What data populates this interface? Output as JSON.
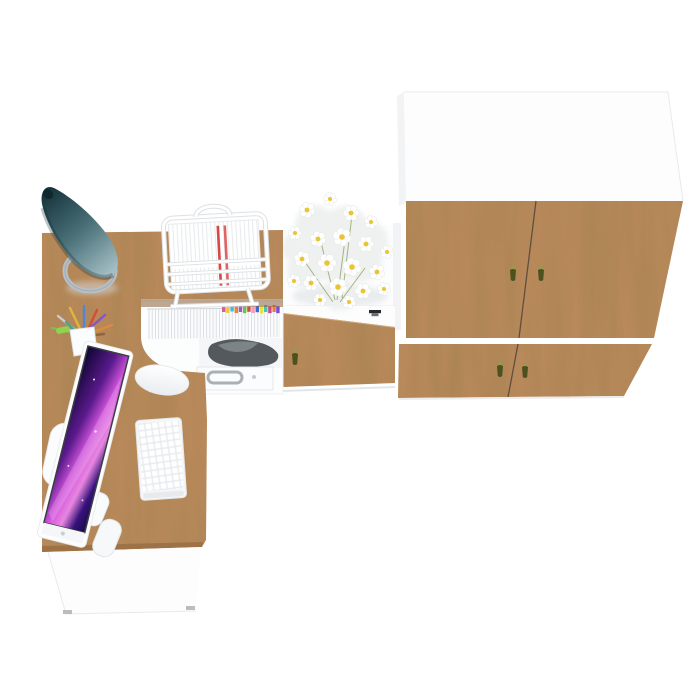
{
  "meta": {
    "description": "Top-down 3D product render of a home-office furniture set: L-shaped oak desk with white base, hutch shelf with files, mid cabinet with flowers, and a four-door oak wardrobe",
    "background": "#ffffff"
  },
  "colors": {
    "bg": "#ffffff",
    "wood-base": "#b8895a",
    "wood-edge": "#8a6138",
    "panel-white": "#fdfdfe",
    "panel-gray": "#f2f3f4",
    "line-gray": "#e7eaec",
    "seam": "#50453c",
    "lamp-dark": "#16343c",
    "lamp-mid": "#4a7078",
    "lamp-light": "#a3bec4",
    "lamp-base": "#b6bfc4",
    "screen-deep": "#0d0530",
    "screen-violet": "#5a1a8c",
    "screen-pink": "#d455dd",
    "screen-blue": "#4aa0e8",
    "handle-olive": "#4c511f",
    "handle-olive-light": "#979c4a",
    "handle-metal": "#a9b1b5",
    "handle-black": "#26292b",
    "daisy-center": "#eac433",
    "leaf-green": "#88a066",
    "printer-dark": "#54595d",
    "printer-light": "#7d8488",
    "paper-line": "#dfe3e6",
    "paper-red": "#d84848"
  },
  "tab_colors": [
    "#e255a0",
    "#f2c83a",
    "#45b8e0",
    "#e8833c",
    "#9a5ad0",
    "#6cc24e",
    "#d84a3a",
    "#f0a0c0",
    "#3a6ad8",
    "#e8e23a",
    "#40c8b0",
    "#c84a8a",
    "#f07a3a",
    "#7a4ad8"
  ],
  "pen_colors": [
    "#c8cdd1",
    "#e0b63a",
    "#4f86d8",
    "#d84a3a",
    "#7ac24e",
    "#8456c8",
    "#e08a3c",
    "#3aa8a0",
    "#90653a"
  ],
  "objects": {
    "desk": "l-shaped-oak-desk",
    "lamp": "teal-cone-desk-lamp",
    "monitor": "white-all-in-one-monitor",
    "keyboard": "white-wireless-keyboard",
    "mouse": "white-wireless-mouse",
    "pencil_cup": "pencil-cup-with-pens",
    "document_tray": "white-wire-document-tray",
    "files": "row-of-files-with-color-tabs",
    "printer": "dark-device-on-shelf",
    "drawer": "white-drawer-with-metal-handle",
    "mid_cabinet": "white-cabinet-with-oak-drawer",
    "flowers": "white-daisy-bouquet",
    "wardrobe": "oak-and-white-four-door-wardrobe"
  }
}
